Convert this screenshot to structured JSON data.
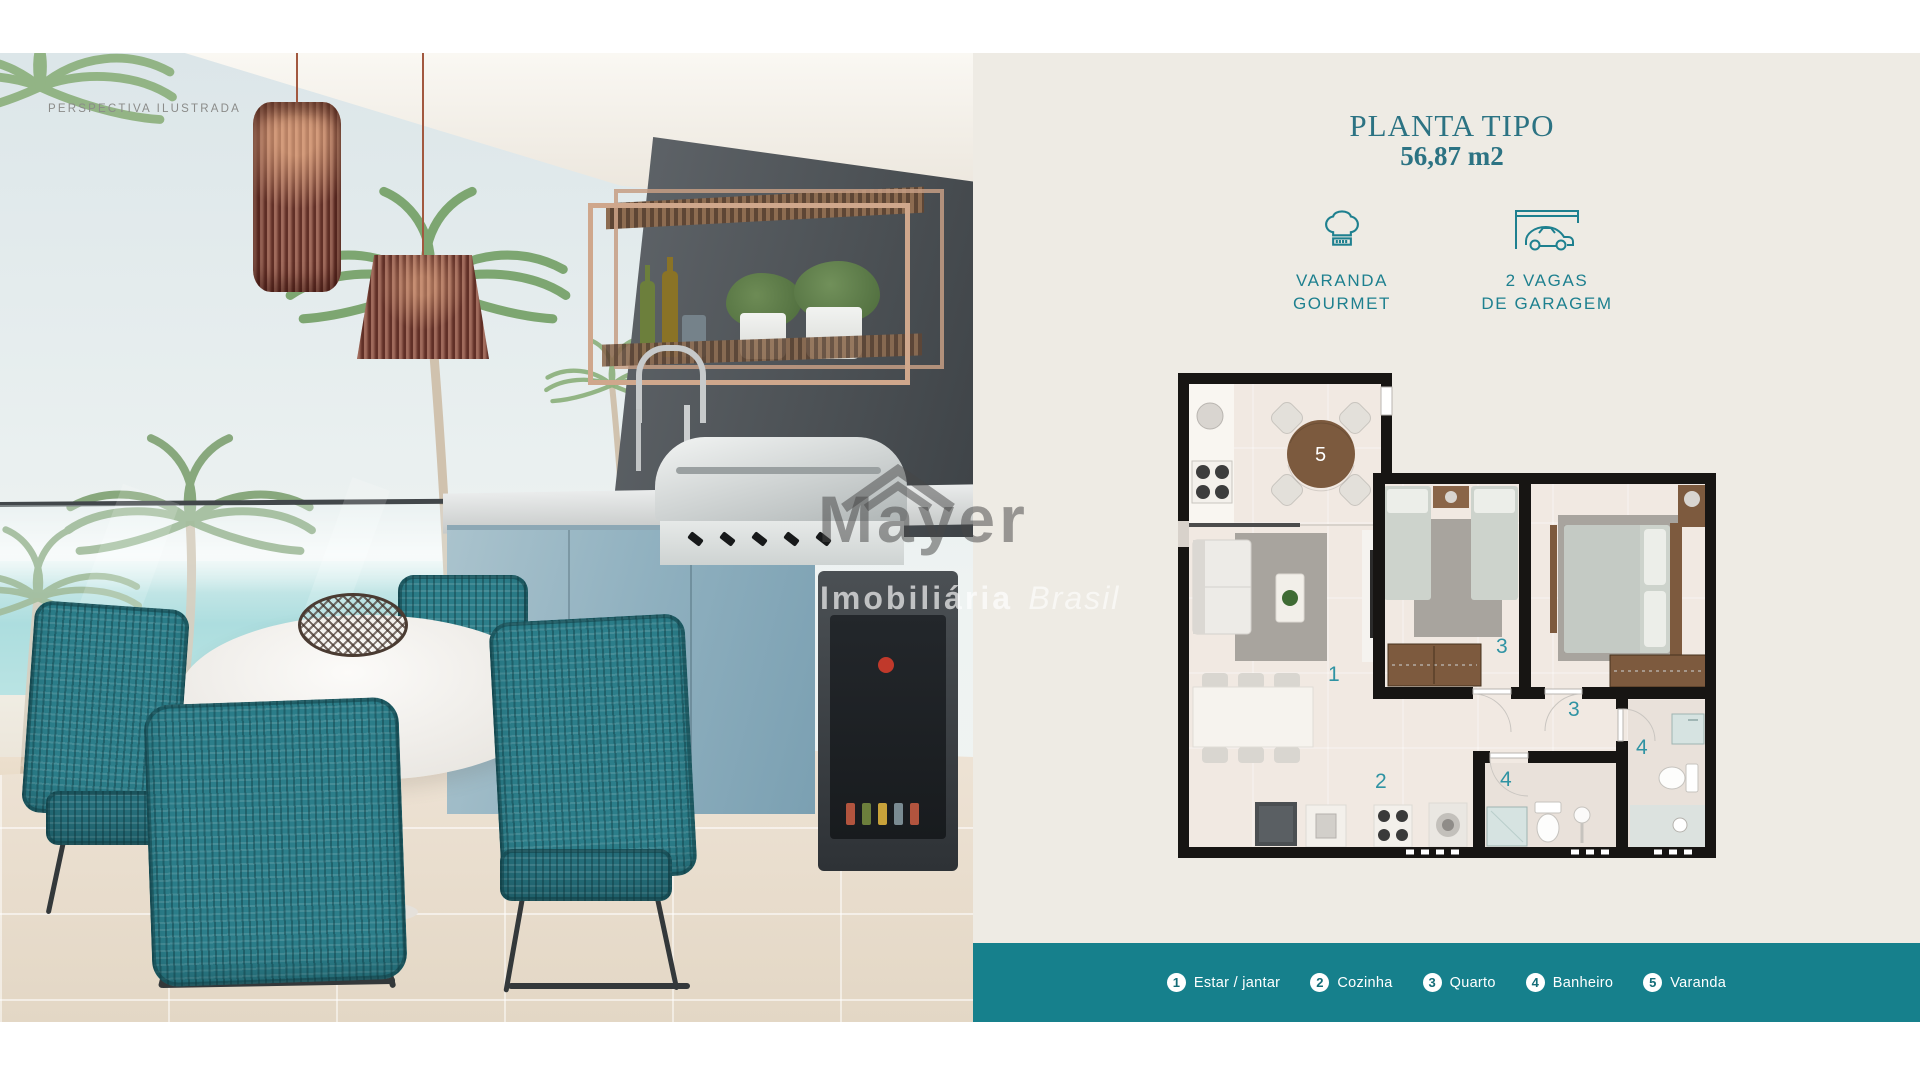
{
  "photo": {
    "label": "PERSPECTIVA ILUSTRADA",
    "watermark": {
      "brand": "Mayer",
      "line2": "Imobiliária",
      "line3": "Brasil"
    }
  },
  "panel": {
    "title": "PLANTA TIPO",
    "area": "56,87 m2",
    "amenities": [
      {
        "icon": "chef-hat-icon",
        "lines": [
          "VARANDA",
          "GOURMET"
        ]
      },
      {
        "icon": "garage-car-icon",
        "lines": [
          "2 VAGAS",
          "DE GARAGEM"
        ]
      }
    ]
  },
  "plan": {
    "label": "PERSPECTIVA ILUSTRADA",
    "numbers": {
      "living": "1",
      "kitchen": "2",
      "bedroom_a": "3",
      "hall": "3",
      "bath_a": "4",
      "bath_b": "4",
      "varanda": "5"
    }
  },
  "legend": {
    "items": [
      {
        "num": "1",
        "label": "Estar / jantar"
      },
      {
        "num": "2",
        "label": "Cozinha"
      },
      {
        "num": "3",
        "label": "Quarto"
      },
      {
        "num": "4",
        "label": "Banheiro"
      },
      {
        "num": "5",
        "label": "Varanda"
      }
    ]
  },
  "colors": {
    "accent_teal": "#16808c",
    "title_teal": "#2c7383",
    "plan_number_teal": "#2f93a3",
    "background_beige": "#eeebe4",
    "plan_wall": "#171513",
    "wood": "#7d5a3e",
    "sea": "#8fd2d4",
    "chair_teal": "#2c7e8a"
  }
}
